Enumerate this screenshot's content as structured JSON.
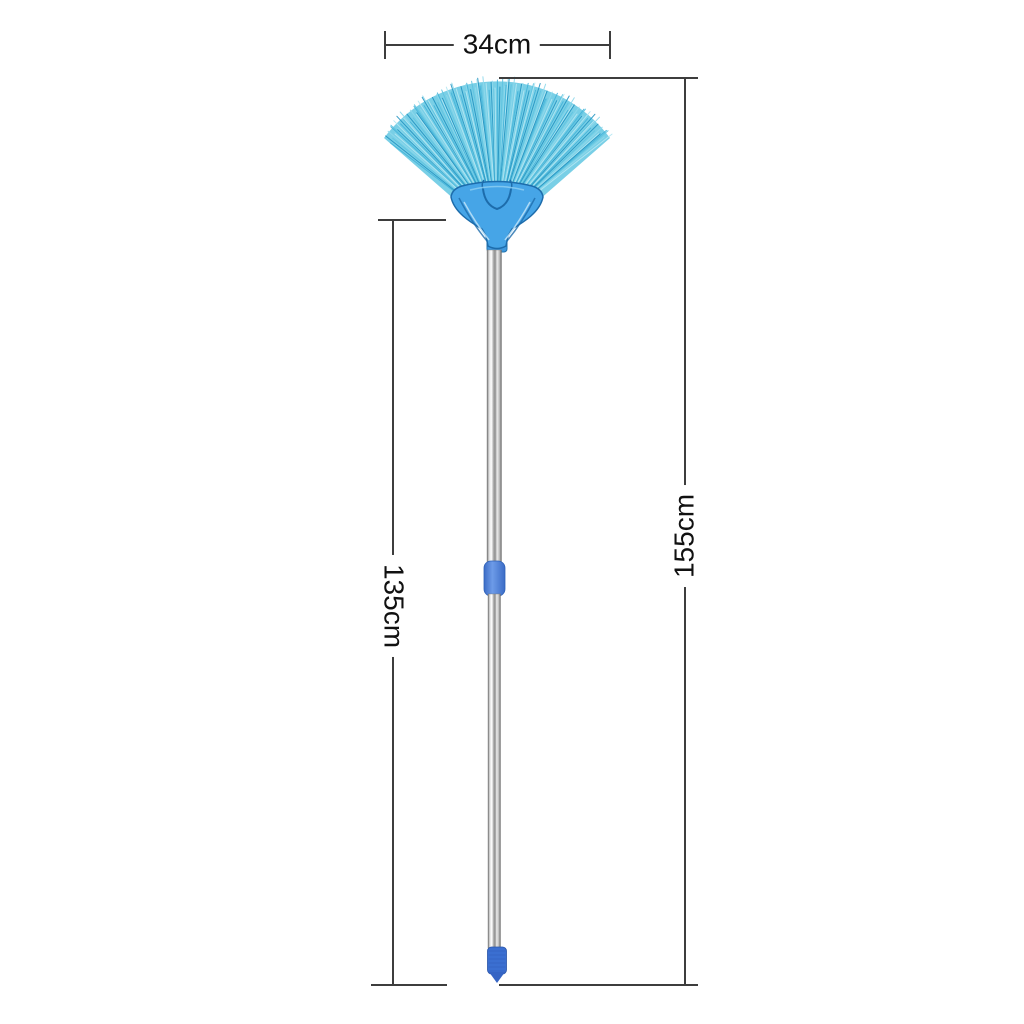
{
  "dimensions": {
    "width_label": "34cm",
    "handle_label": "135cm",
    "total_label": "155cm",
    "line_color": "#3d3d3d",
    "label_color": "#111111"
  },
  "product": {
    "type": "fan-shaped ceiling broom with telescopic handle",
    "colors": {
      "bristles_main": "#45b4da",
      "bristles_light": "#8fd9ec",
      "bristles_dark": "#2595c2",
      "bristles_pale": "#b5e7f3",
      "bristles_mid": "#5fc4e0",
      "bristles_silhouette": "#79cfe6",
      "head": "#46a5e7",
      "head_outline": "#1d6cab",
      "ferrule": "#3d98de",
      "collar": "#4d82de",
      "grip": "#3b6fd1",
      "grip_tip": "#3564c4",
      "pole_dark": "#707070",
      "pole_light": "#ffffff"
    }
  }
}
